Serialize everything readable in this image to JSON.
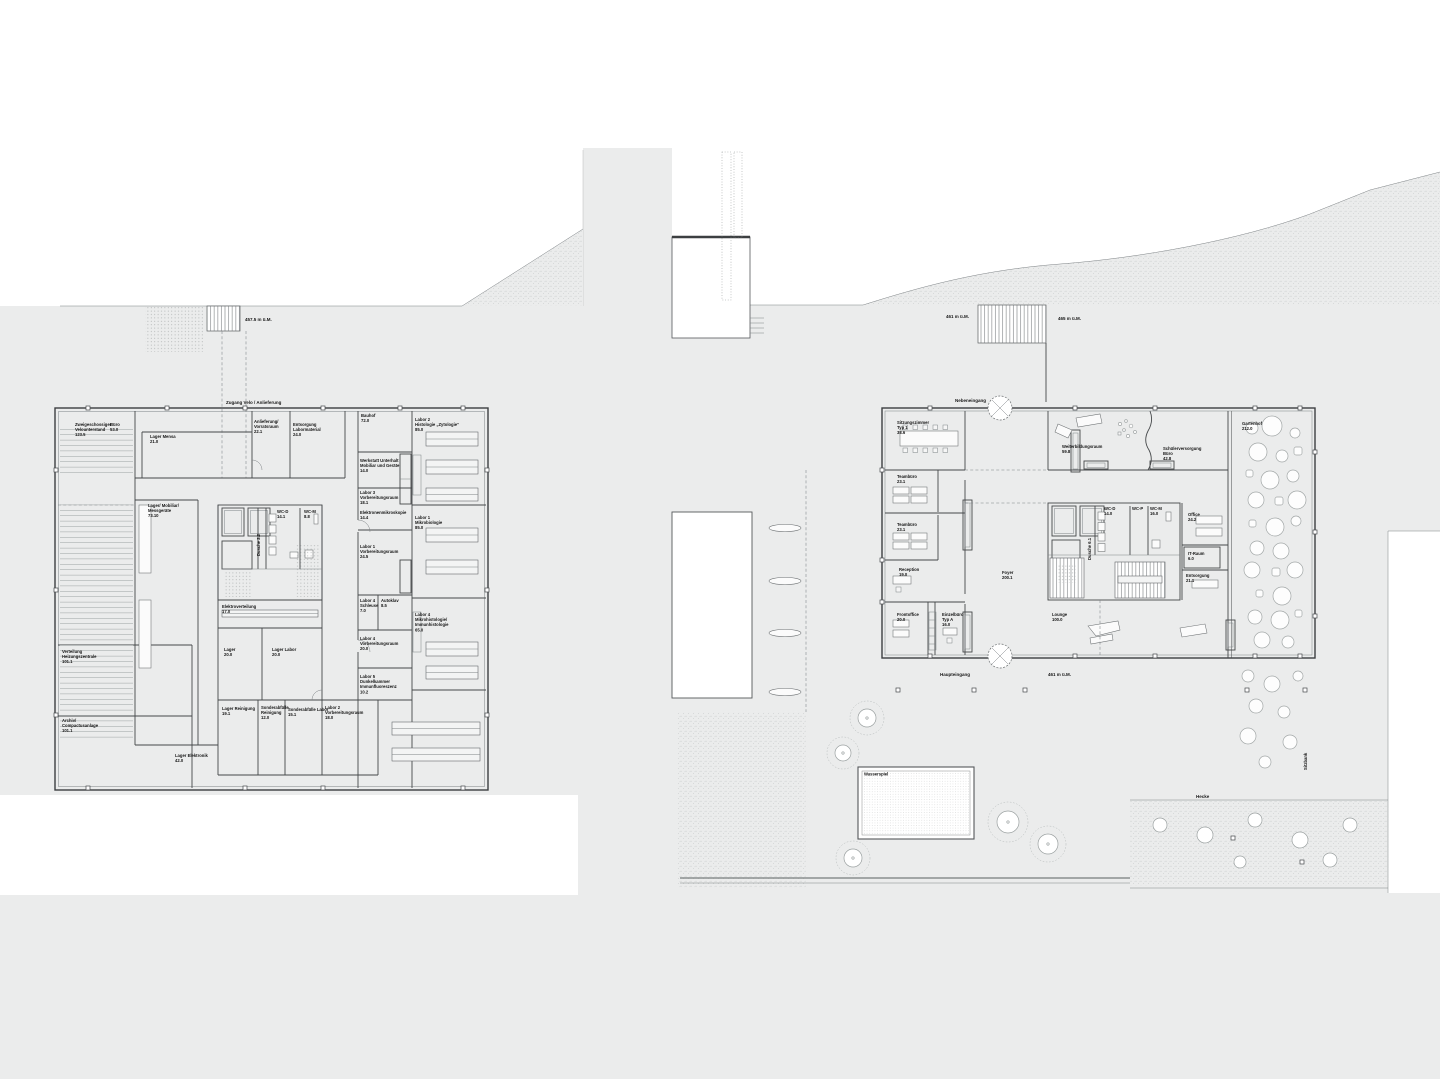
{
  "colors": {
    "background": "#ebecec",
    "paper_white": "#ffffff",
    "wall_line": "#45484a",
    "light_line": "#7d8285",
    "stipple_dot": "#b2b6b6",
    "label_text": "#161616"
  },
  "left_plan": {
    "site_labels": {
      "access": "Zugang Velo / Anlieferung",
      "elevation": "457.5 m ü.M."
    },
    "rooms": [
      {
        "lines": [
          "Zweigeschossiger",
          "Velounterstand",
          "123.5"
        ]
      },
      {
        "lines": [
          "Büro",
          "53.0"
        ]
      },
      {
        "lines": [
          "Lager Mensa",
          "21.0"
        ]
      },
      {
        "lines": [
          "Anlieferung/",
          "Vorratsraum",
          "22.1"
        ]
      },
      {
        "lines": [
          "Entsorgung",
          "Labormaterial",
          "24.0"
        ]
      },
      {
        "lines": [
          "Bauhof",
          "72.0"
        ]
      },
      {
        "lines": [
          "Labor 2",
          "Histologie „Zytologie“",
          "85.0"
        ]
      },
      {
        "lines": [
          "Werkstatt Unterhalt",
          "Mobiliar und Geräte",
          "14.0"
        ]
      },
      {
        "lines": [
          "Labor 3",
          "Vorbereitungsraum",
          "18.1"
        ]
      },
      {
        "lines": [
          "Elektronenmikroskopie",
          "14.4"
        ]
      },
      {
        "lines": [
          "Labor 1",
          "Mikrobiologie",
          "85.0"
        ]
      },
      {
        "lines": [
          "Labor 1",
          "Vorbereitungsraum",
          "24.5"
        ]
      },
      {
        "lines": [
          "Lager/ Mobiliar/",
          "Messgeräte",
          "73.10"
        ]
      },
      {
        "lines": [
          "WC-D",
          "14.1"
        ]
      },
      {
        "lines": [
          "WC-M",
          "8.8"
        ]
      },
      {
        "lines": [
          "Dusche 2.2"
        ]
      },
      {
        "lines": [
          "Elektroverteilung",
          "17.0"
        ]
      },
      {
        "lines": [
          "Labor 4",
          "Schleuse",
          "7.0"
        ]
      },
      {
        "lines": [
          "Autoklav",
          "8.5"
        ]
      },
      {
        "lines": [
          "Labor 4",
          "Mikrohistologie/",
          "Immunhistologie",
          "65.0"
        ]
      },
      {
        "lines": [
          "Labor 4",
          "Vorbereitungsraum",
          "20.0"
        ]
      },
      {
        "lines": [
          "Lager",
          "20.0"
        ]
      },
      {
        "lines": [
          "Lager Labor",
          "20.0"
        ]
      },
      {
        "lines": [
          "Labor 5",
          "Dunkelkammer",
          "Immunfluoreszenz",
          "10.2"
        ]
      },
      {
        "lines": [
          "Verteilung",
          "Heizungszentrale",
          "101.1"
        ]
      },
      {
        "lines": [
          "Archiv/",
          "Compactusanlage",
          "101.1"
        ]
      },
      {
        "lines": [
          "Lager Reinigung",
          "19.1"
        ]
      },
      {
        "lines": [
          "Sonderabfälle",
          "Reinigung",
          "12.0"
        ]
      },
      {
        "lines": [
          "Sonderabfälle Labor",
          "15.1"
        ]
      },
      {
        "lines": [
          "Labor 2",
          "Vorbereitungsraum",
          "18.0"
        ]
      },
      {
        "lines": [
          "Lager Elektronik",
          "42.0"
        ]
      }
    ]
  },
  "right_plan": {
    "site_labels": {
      "side_entrance": "Nebeneingang",
      "elevation_stair_bottom": "461 m ü.M.",
      "elevation_stair_top": "465 m ü.M.",
      "main_entrance": "Haupteingang",
      "elevation_entrance": "461 m ü.M.",
      "water_feature": "Wasserspiel",
      "hedge": "Hecke",
      "bench": "Sitzbank"
    },
    "rooms": [
      {
        "lines": [
          "Sitzungszimmer",
          "Typ 1",
          "38.6"
        ]
      },
      {
        "lines": [
          "Teambüro",
          "23.1"
        ]
      },
      {
        "lines": [
          "Teambüro",
          "23.1"
        ]
      },
      {
        "lines": [
          "Reception",
          "19.0"
        ]
      },
      {
        "lines": [
          "Weiterbildungsraum",
          "59.8"
        ]
      },
      {
        "lines": [
          "Schülerversorgung",
          "Büro",
          "42.8"
        ]
      },
      {
        "lines": [
          "Gartenhof",
          "212.0"
        ]
      },
      {
        "lines": [
          "WC-D",
          "14.0"
        ]
      },
      {
        "lines": [
          "WC-P"
        ]
      },
      {
        "lines": [
          "WC-M",
          "16.0"
        ]
      },
      {
        "lines": [
          "Dusche 6.1"
        ]
      },
      {
        "lines": [
          "Office",
          "24.2"
        ]
      },
      {
        "lines": [
          "IT-Raum",
          "6.0"
        ]
      },
      {
        "lines": [
          "Entsorgung",
          "21.1"
        ]
      },
      {
        "lines": [
          "Foyer",
          "200.1"
        ]
      },
      {
        "lines": [
          "Lounge",
          "100.0"
        ]
      },
      {
        "lines": [
          "Frontoffice",
          "20.0"
        ]
      },
      {
        "lines": [
          "Einzelbüro",
          "Typ A",
          "16.0"
        ]
      }
    ]
  }
}
